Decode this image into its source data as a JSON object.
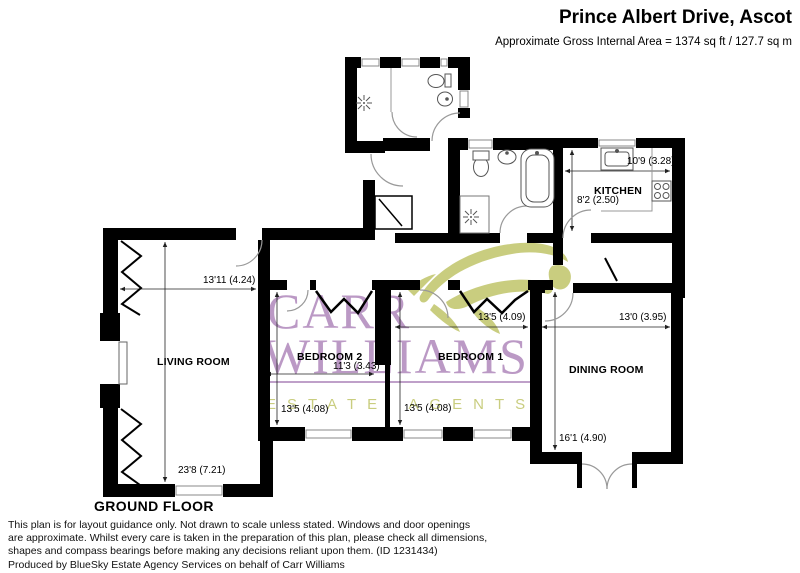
{
  "header": {
    "title": "Prince Albert Drive, Ascot",
    "area_line": "Approximate Gross Internal Area = 1374 sq ft / 127.7 sq m"
  },
  "floor_label": "GROUND FLOOR",
  "rooms": {
    "living": {
      "name": "LIVING ROOM",
      "width_dim": "13'11 (4.24)",
      "height_dim": "23'8 (7.21)"
    },
    "bedroom2": {
      "name": "BEDROOM 2",
      "width_dim": "11'3 (3.43)",
      "height_dim": "13'5 (4.08)"
    },
    "bedroom1": {
      "name": "BEDROOM 1",
      "width_dim": "13'5 (4.09)",
      "height_dim": "13'5 (4.08)"
    },
    "dining": {
      "name": "DINING ROOM",
      "width_dim": "13'0 (3.95)",
      "height_dim": "16'1 (4.90)"
    },
    "kitchen": {
      "name": "KITCHEN",
      "width_dim": "10'9 (3.28)",
      "height_dim": "8'2 (2.50)"
    }
  },
  "watermark": {
    "line1": "CARR",
    "line2": "WILLIAMS",
    "line3": "ESTATE AGENTS"
  },
  "disclaimer": {
    "lines": [
      "This plan is for layout guidance only. Not drawn to scale unless stated. Windows and door openings",
      "are approximate. Whilst every care is taken in the preparation of this plan, please check all dimensions,",
      "shapes and compass bearings before making any decisions reliant upon them. (ID 1231434)",
      "Produced by BlueSky Estate Agency Services on behalf of Carr Williams"
    ]
  },
  "colors": {
    "wall": "#000000",
    "watermark_purple": "#aa80b7",
    "watermark_olive": "#c9cc7a"
  }
}
